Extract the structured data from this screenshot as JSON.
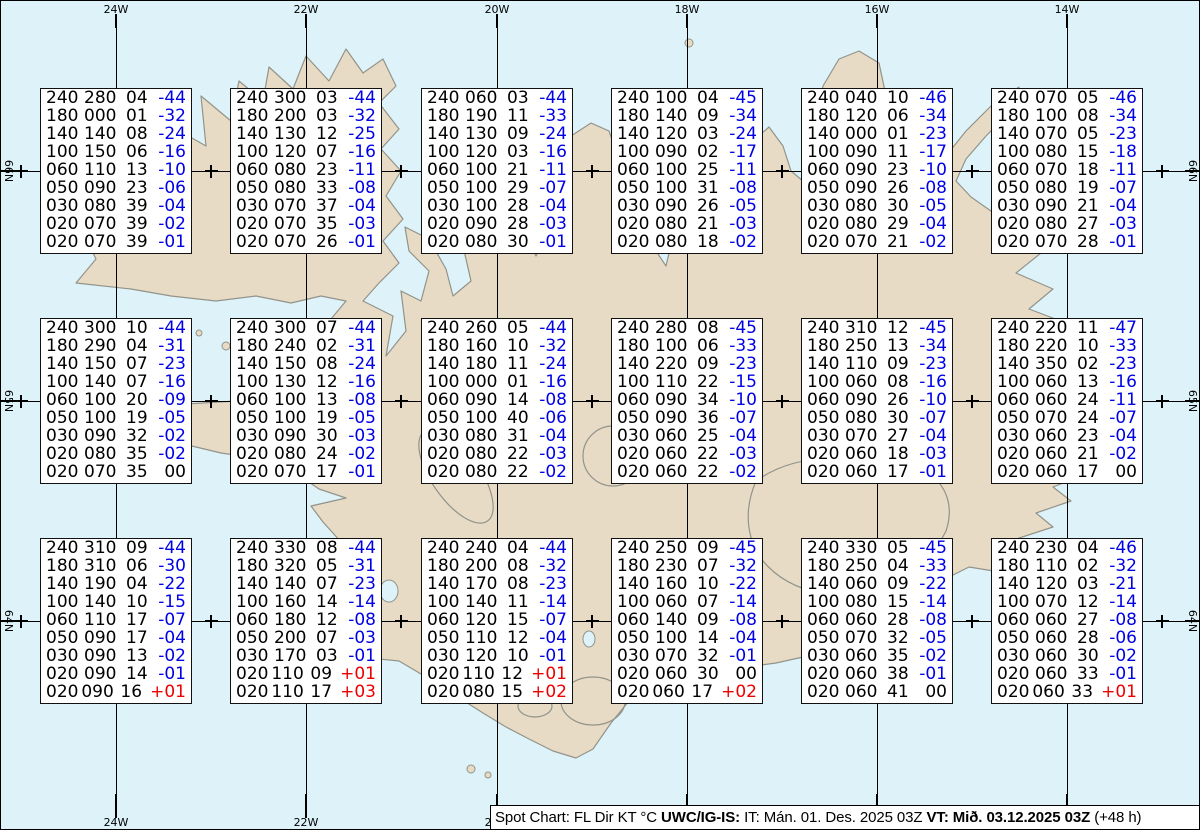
{
  "map": {
    "sea_color": "#ddf3f9",
    "land_color": "#e7dbc6",
    "coast_color": "#93938a",
    "meridians": [
      {
        "label": "24W",
        "x": 115
      },
      {
        "label": "22W",
        "x": 305
      },
      {
        "label": "20W",
        "x": 496
      },
      {
        "label": "18W",
        "x": 686
      },
      {
        "label": "16W",
        "x": 876
      },
      {
        "label": "14W",
        "x": 1066
      }
    ],
    "parallels": [
      {
        "label": "66N",
        "y": 170
      },
      {
        "label": "65N",
        "y": 400
      },
      {
        "label": "64N",
        "y": 620
      }
    ],
    "minor_crosses_x": [
      20,
      210,
      400,
      591,
      781,
      971,
      1161
    ]
  },
  "stations": [
    {
      "col": 0,
      "row": 0,
      "levels": [
        [
          "240",
          "280",
          "04",
          "-44"
        ],
        [
          "180",
          "000",
          "01",
          "-32"
        ],
        [
          "140",
          "140",
          "08",
          "-24"
        ],
        [
          "100",
          "150",
          "06",
          "-16"
        ],
        [
          "060",
          "110",
          "13",
          "-10"
        ],
        [
          "050",
          "090",
          "23",
          "-06"
        ],
        [
          "030",
          "080",
          "39",
          "-04"
        ],
        [
          "020",
          "070",
          "39",
          "-02"
        ],
        [
          "020",
          "070",
          "39",
          "-01"
        ]
      ]
    },
    {
      "col": 1,
      "row": 0,
      "levels": [
        [
          "240",
          "300",
          "03",
          "-44"
        ],
        [
          "180",
          "200",
          "03",
          "-32"
        ],
        [
          "140",
          "130",
          "12",
          "-25"
        ],
        [
          "100",
          "120",
          "07",
          "-16"
        ],
        [
          "060",
          "080",
          "23",
          "-11"
        ],
        [
          "050",
          "080",
          "33",
          "-08"
        ],
        [
          "030",
          "070",
          "37",
          "-04"
        ],
        [
          "020",
          "070",
          "35",
          "-03"
        ],
        [
          "020",
          "070",
          "26",
          "-01"
        ]
      ]
    },
    {
      "col": 2,
      "row": 0,
      "levels": [
        [
          "240",
          "060",
          "03",
          "-44"
        ],
        [
          "180",
          "190",
          "11",
          "-33"
        ],
        [
          "140",
          "130",
          "09",
          "-24"
        ],
        [
          "100",
          "120",
          "03",
          "-16"
        ],
        [
          "060",
          "100",
          "21",
          "-11"
        ],
        [
          "050",
          "100",
          "29",
          "-07"
        ],
        [
          "030",
          "100",
          "28",
          "-04"
        ],
        [
          "020",
          "090",
          "28",
          "-03"
        ],
        [
          "020",
          "080",
          "30",
          "-01"
        ]
      ]
    },
    {
      "col": 3,
      "row": 0,
      "levels": [
        [
          "240",
          "100",
          "04",
          "-45"
        ],
        [
          "180",
          "140",
          "09",
          "-34"
        ],
        [
          "140",
          "120",
          "03",
          "-24"
        ],
        [
          "100",
          "090",
          "02",
          "-17"
        ],
        [
          "060",
          "100",
          "25",
          "-11"
        ],
        [
          "050",
          "100",
          "31",
          "-08"
        ],
        [
          "030",
          "090",
          "26",
          "-05"
        ],
        [
          "020",
          "080",
          "21",
          "-03"
        ],
        [
          "020",
          "080",
          "18",
          "-02"
        ]
      ]
    },
    {
      "col": 4,
      "row": 0,
      "levels": [
        [
          "240",
          "040",
          "10",
          "-46"
        ],
        [
          "180",
          "120",
          "06",
          "-34"
        ],
        [
          "140",
          "000",
          "01",
          "-23"
        ],
        [
          "100",
          "090",
          "11",
          "-17"
        ],
        [
          "060",
          "090",
          "23",
          "-10"
        ],
        [
          "050",
          "090",
          "26",
          "-08"
        ],
        [
          "030",
          "080",
          "30",
          "-05"
        ],
        [
          "020",
          "080",
          "29",
          "-04"
        ],
        [
          "020",
          "070",
          "21",
          "-02"
        ]
      ]
    },
    {
      "col": 5,
      "row": 0,
      "levels": [
        [
          "240",
          "070",
          "05",
          "-46"
        ],
        [
          "180",
          "100",
          "08",
          "-34"
        ],
        [
          "140",
          "070",
          "05",
          "-23"
        ],
        [
          "100",
          "080",
          "15",
          "-18"
        ],
        [
          "060",
          "070",
          "18",
          "-11"
        ],
        [
          "050",
          "080",
          "19",
          "-07"
        ],
        [
          "030",
          "090",
          "21",
          "-04"
        ],
        [
          "020",
          "080",
          "27",
          "-03"
        ],
        [
          "020",
          "070",
          "28",
          "-01"
        ]
      ]
    },
    {
      "col": 0,
      "row": 1,
      "levels": [
        [
          "240",
          "300",
          "10",
          "-44"
        ],
        [
          "180",
          "290",
          "04",
          "-31"
        ],
        [
          "140",
          "150",
          "07",
          "-23"
        ],
        [
          "100",
          "140",
          "07",
          "-16"
        ],
        [
          "060",
          "100",
          "20",
          "-09"
        ],
        [
          "050",
          "100",
          "19",
          "-05"
        ],
        [
          "030",
          "090",
          "32",
          "-02"
        ],
        [
          "020",
          "080",
          "35",
          "-02"
        ],
        [
          "020",
          "070",
          "35",
          "00"
        ]
      ]
    },
    {
      "col": 1,
      "row": 1,
      "levels": [
        [
          "240",
          "300",
          "07",
          "-44"
        ],
        [
          "180",
          "240",
          "02",
          "-31"
        ],
        [
          "140",
          "150",
          "08",
          "-24"
        ],
        [
          "100",
          "130",
          "12",
          "-16"
        ],
        [
          "060",
          "100",
          "13",
          "-08"
        ],
        [
          "050",
          "100",
          "19",
          "-05"
        ],
        [
          "030",
          "090",
          "30",
          "-03"
        ],
        [
          "020",
          "080",
          "24",
          "-02"
        ],
        [
          "020",
          "070",
          "17",
          "-01"
        ]
      ]
    },
    {
      "col": 2,
      "row": 1,
      "levels": [
        [
          "240",
          "260",
          "05",
          "-44"
        ],
        [
          "180",
          "160",
          "10",
          "-32"
        ],
        [
          "140",
          "180",
          "11",
          "-24"
        ],
        [
          "100",
          "000",
          "01",
          "-16"
        ],
        [
          "060",
          "090",
          "14",
          "-08"
        ],
        [
          "050",
          "100",
          "40",
          "-06"
        ],
        [
          "030",
          "080",
          "31",
          "-04"
        ],
        [
          "020",
          "080",
          "22",
          "-03"
        ],
        [
          "020",
          "080",
          "22",
          "-02"
        ]
      ]
    },
    {
      "col": 3,
      "row": 1,
      "levels": [
        [
          "240",
          "280",
          "08",
          "-45"
        ],
        [
          "180",
          "100",
          "06",
          "-33"
        ],
        [
          "140",
          "220",
          "09",
          "-23"
        ],
        [
          "100",
          "110",
          "22",
          "-15"
        ],
        [
          "060",
          "090",
          "34",
          "-10"
        ],
        [
          "050",
          "090",
          "36",
          "-07"
        ],
        [
          "030",
          "060",
          "25",
          "-04"
        ],
        [
          "020",
          "060",
          "22",
          "-03"
        ],
        [
          "020",
          "060",
          "22",
          "-02"
        ]
      ]
    },
    {
      "col": 4,
      "row": 1,
      "levels": [
        [
          "240",
          "310",
          "12",
          "-45"
        ],
        [
          "180",
          "250",
          "13",
          "-34"
        ],
        [
          "140",
          "110",
          "09",
          "-23"
        ],
        [
          "100",
          "060",
          "08",
          "-16"
        ],
        [
          "060",
          "090",
          "26",
          "-10"
        ],
        [
          "050",
          "080",
          "30",
          "-07"
        ],
        [
          "030",
          "070",
          "27",
          "-04"
        ],
        [
          "020",
          "060",
          "18",
          "-03"
        ],
        [
          "020",
          "060",
          "17",
          "-01"
        ]
      ]
    },
    {
      "col": 5,
      "row": 1,
      "levels": [
        [
          "240",
          "220",
          "11",
          "-47"
        ],
        [
          "180",
          "220",
          "10",
          "-33"
        ],
        [
          "140",
          "350",
          "02",
          "-23"
        ],
        [
          "100",
          "060",
          "13",
          "-16"
        ],
        [
          "060",
          "060",
          "24",
          "-11"
        ],
        [
          "050",
          "070",
          "24",
          "-07"
        ],
        [
          "030",
          "060",
          "23",
          "-04"
        ],
        [
          "020",
          "060",
          "21",
          "-02"
        ],
        [
          "020",
          "060",
          "17",
          "00"
        ]
      ]
    },
    {
      "col": 0,
      "row": 2,
      "levels": [
        [
          "240",
          "310",
          "09",
          "-44"
        ],
        [
          "180",
          "310",
          "06",
          "-30"
        ],
        [
          "140",
          "190",
          "04",
          "-22"
        ],
        [
          "100",
          "140",
          "10",
          "-15"
        ],
        [
          "060",
          "110",
          "17",
          "-07"
        ],
        [
          "050",
          "090",
          "17",
          "-04"
        ],
        [
          "030",
          "090",
          "13",
          "-02"
        ],
        [
          "020",
          "090",
          "14",
          "-01"
        ],
        [
          "020",
          "090",
          "16",
          "+01"
        ]
      ]
    },
    {
      "col": 1,
      "row": 2,
      "levels": [
        [
          "240",
          "330",
          "08",
          "-44"
        ],
        [
          "180",
          "320",
          "05",
          "-31"
        ],
        [
          "140",
          "140",
          "07",
          "-23"
        ],
        [
          "100",
          "160",
          "14",
          "-14"
        ],
        [
          "060",
          "180",
          "12",
          "-08"
        ],
        [
          "050",
          "200",
          "07",
          "-03"
        ],
        [
          "030",
          "170",
          "03",
          "-01"
        ],
        [
          "020",
          "110",
          "09",
          "+01"
        ],
        [
          "020",
          "110",
          "17",
          "+03"
        ]
      ]
    },
    {
      "col": 2,
      "row": 2,
      "levels": [
        [
          "240",
          "240",
          "04",
          "-44"
        ],
        [
          "180",
          "200",
          "08",
          "-32"
        ],
        [
          "140",
          "170",
          "08",
          "-23"
        ],
        [
          "100",
          "140",
          "11",
          "-14"
        ],
        [
          "060",
          "120",
          "15",
          "-07"
        ],
        [
          "050",
          "110",
          "12",
          "-04"
        ],
        [
          "030",
          "120",
          "10",
          "-01"
        ],
        [
          "020",
          "110",
          "12",
          "+01"
        ],
        [
          "020",
          "080",
          "15",
          "+02"
        ]
      ]
    },
    {
      "col": 3,
      "row": 2,
      "levels": [
        [
          "240",
          "250",
          "09",
          "-45"
        ],
        [
          "180",
          "230",
          "07",
          "-32"
        ],
        [
          "140",
          "160",
          "10",
          "-22"
        ],
        [
          "100",
          "060",
          "07",
          "-14"
        ],
        [
          "060",
          "140",
          "09",
          "-08"
        ],
        [
          "050",
          "100",
          "14",
          "-04"
        ],
        [
          "030",
          "070",
          "32",
          "-01"
        ],
        [
          "020",
          "060",
          "30",
          "00"
        ],
        [
          "020",
          "060",
          "17",
          "+02"
        ]
      ]
    },
    {
      "col": 4,
      "row": 2,
      "levels": [
        [
          "240",
          "330",
          "05",
          "-45"
        ],
        [
          "180",
          "250",
          "04",
          "-33"
        ],
        [
          "140",
          "060",
          "09",
          "-22"
        ],
        [
          "100",
          "080",
          "15",
          "-14"
        ],
        [
          "060",
          "060",
          "28",
          "-08"
        ],
        [
          "050",
          "070",
          "32",
          "-05"
        ],
        [
          "030",
          "060",
          "35",
          "-02"
        ],
        [
          "020",
          "060",
          "38",
          "-01"
        ],
        [
          "020",
          "060",
          "41",
          "00"
        ]
      ]
    },
    {
      "col": 5,
      "row": 2,
      "levels": [
        [
          "240",
          "230",
          "04",
          "-46"
        ],
        [
          "180",
          "110",
          "02",
          "-32"
        ],
        [
          "140",
          "120",
          "03",
          "-21"
        ],
        [
          "100",
          "070",
          "12",
          "-14"
        ],
        [
          "060",
          "060",
          "27",
          "-08"
        ],
        [
          "050",
          "060",
          "28",
          "-06"
        ],
        [
          "030",
          "060",
          "30",
          "-02"
        ],
        [
          "020",
          "060",
          "33",
          "-01"
        ],
        [
          "020",
          "060",
          "33",
          "+01"
        ]
      ]
    }
  ],
  "caption": {
    "seg1": "Spot Chart: FL Dir KT °C ",
    "seg2_bold": "UWC/IG-IS:",
    "seg3": " IT: Mán. 01. Des. 2025 03Z ",
    "seg4_bold": "VT: Mið. 03.12.2025 03Z",
    "seg5": " (+48 h)"
  },
  "text_colors": {
    "negative": "#0000e6",
    "positive": "#ee0000",
    "zero": "#000000"
  }
}
